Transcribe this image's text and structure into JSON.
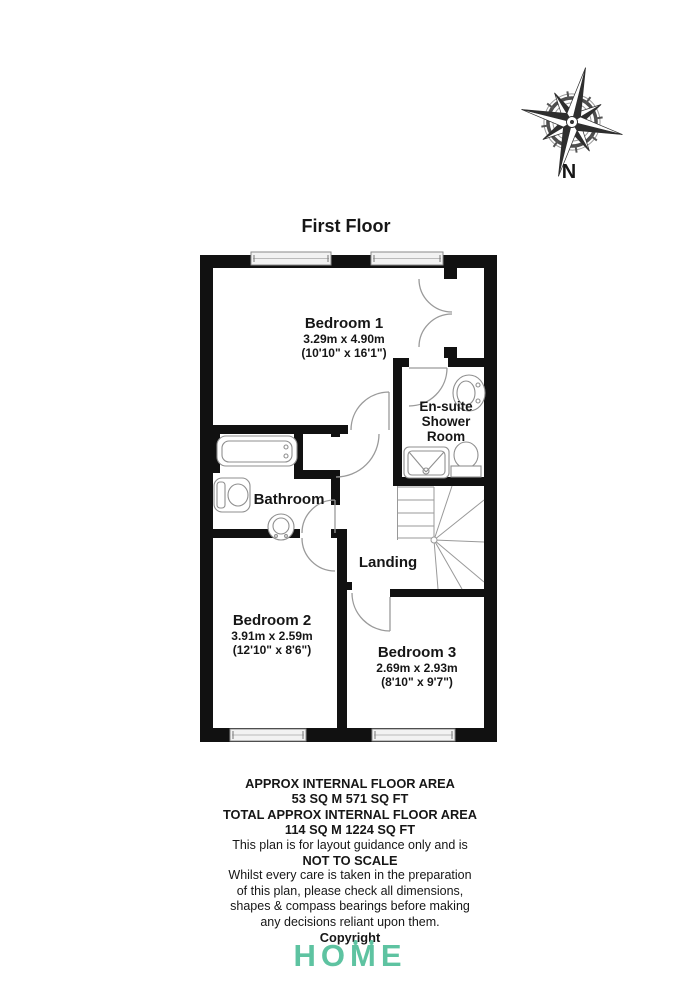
{
  "page": {
    "title": "First Floor",
    "compass_label": "N"
  },
  "rooms": {
    "bedroom1": {
      "name": "Bedroom 1",
      "metric": "3.29m x 4.90m",
      "imperial": "(10'10\" x 16'1\")"
    },
    "ensuite": {
      "line1": "En-suite",
      "line2": "Shower",
      "line3": "Room"
    },
    "bathroom": {
      "name": "Bathroom"
    },
    "landing": {
      "name": "Landing"
    },
    "bedroom2": {
      "name": "Bedroom 2",
      "metric": "3.91m x 2.59m",
      "imperial": "(12'10\" x 8'6\")"
    },
    "bedroom3": {
      "name": "Bedroom 3",
      "metric": "2.69m x 2.93m",
      "imperial": "(8'10\" x 9'7\")"
    }
  },
  "footer": {
    "line1": "APPROX INTERNAL FLOOR AREA",
    "line2": "53 SQ M 571 SQ FT",
    "line3": "TOTAL APPROX INTERNAL FLOOR AREA",
    "line4": "114 SQ M 1224 SQ FT",
    "line5": "This plan is for layout guidance only and is",
    "line6": "NOT TO SCALE",
    "line7": "Whilst every care is taken in the preparation",
    "line8": "of this plan, please check all dimensions,",
    "line9": "shapes & compass bearings before making",
    "line10": "any decisions reliant upon them.",
    "line11": "Copyright"
  },
  "logo": {
    "part1": "HO",
    "part2": "M",
    "part3": "E"
  },
  "colors": {
    "wall": "#111111",
    "fixture_stroke": "#8f8f8f",
    "door_arc": "#9a9a9a",
    "window_fill": "#f2f2f2",
    "logo_teal": "#5EC3A1"
  }
}
